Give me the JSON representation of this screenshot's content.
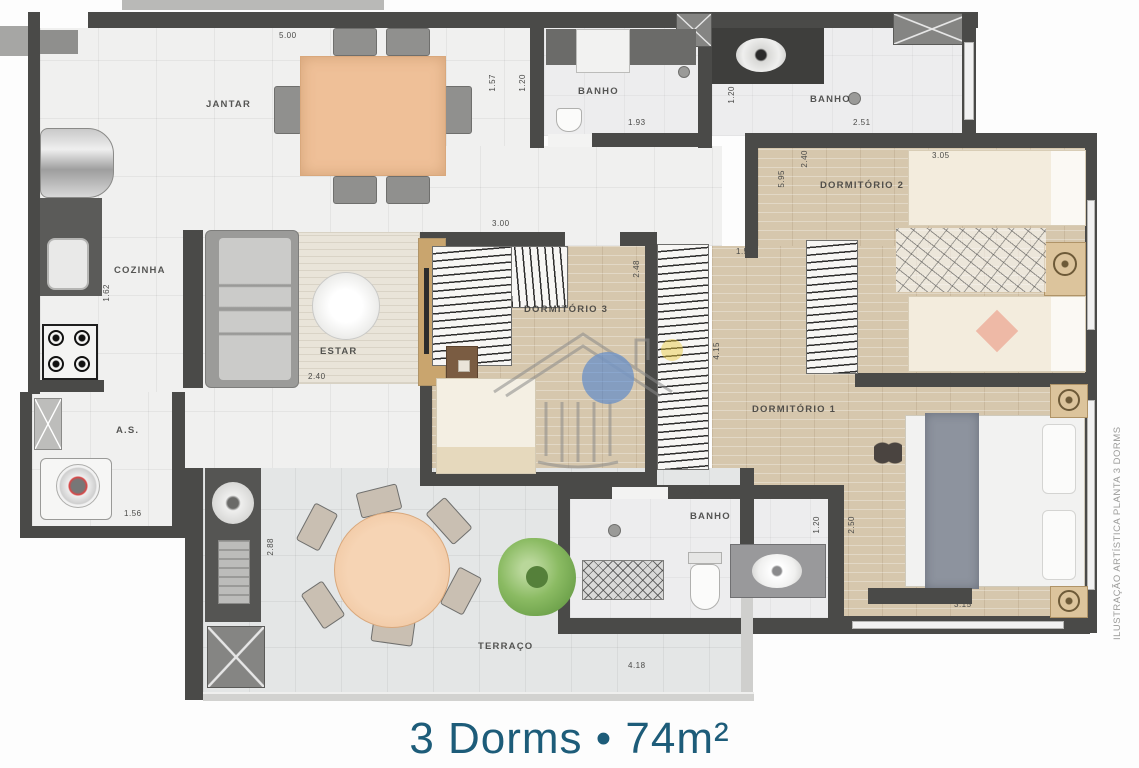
{
  "caption": {
    "text": "3 Dorms • 74m²",
    "color": "#1d5c79"
  },
  "side_note": "ILUSTRAÇÃO ARTÍSTICA PLANTA 3 DORMS",
  "colors": {
    "wall": "#4a4a48",
    "wood_floor": "#d6c7ad",
    "tile_floor": "#e4e6e6",
    "table_wood": "#efc098",
    "accent_blue": "#2b6fd4",
    "caption_teal": "#1d5c79"
  },
  "rooms": {
    "jantar": {
      "label": "JANTAR"
    },
    "cozinha": {
      "label": "COZINHA"
    },
    "estar": {
      "label": "ESTAR"
    },
    "banho_1": {
      "label": "BANHO"
    },
    "banho_2": {
      "label": "BANHO"
    },
    "banho_3": {
      "label": "BANHO"
    },
    "dormitorio_1": {
      "label": "DORMITÓRIO 1"
    },
    "dormitorio_2": {
      "label": "DORMITÓRIO 2"
    },
    "dormitorio_3": {
      "label": "DORMITÓRIO 3"
    },
    "area_servico": {
      "label": "A.S."
    },
    "terraco": {
      "label": "TERRAÇO"
    }
  },
  "dimensions": {
    "jantar_top": "5.00",
    "banho1_left_a": "1.57",
    "banho1_left_b": "1.20",
    "banho1_bottom": "1.93",
    "banho2_left": "1.20",
    "banho2_bottom": "2.51",
    "dorm2_left": "2.40",
    "dorm2_outer": "5.95",
    "dorm2_top": "3.05",
    "dorm3_top": "3.00",
    "dorm3_right": "2.48",
    "corridor_top": "1.50",
    "corridor_right": "4.15",
    "estar_bottom": "2.40",
    "cozinha_left": "1.62",
    "as_bottom": "1.56",
    "gourmet_right": "2.88",
    "banho3_top": "2.45",
    "banho3_right": "1.20",
    "dorm1_left": "2.50",
    "dorm1_bed": "3.15",
    "terraco_bottom": "4.18"
  }
}
